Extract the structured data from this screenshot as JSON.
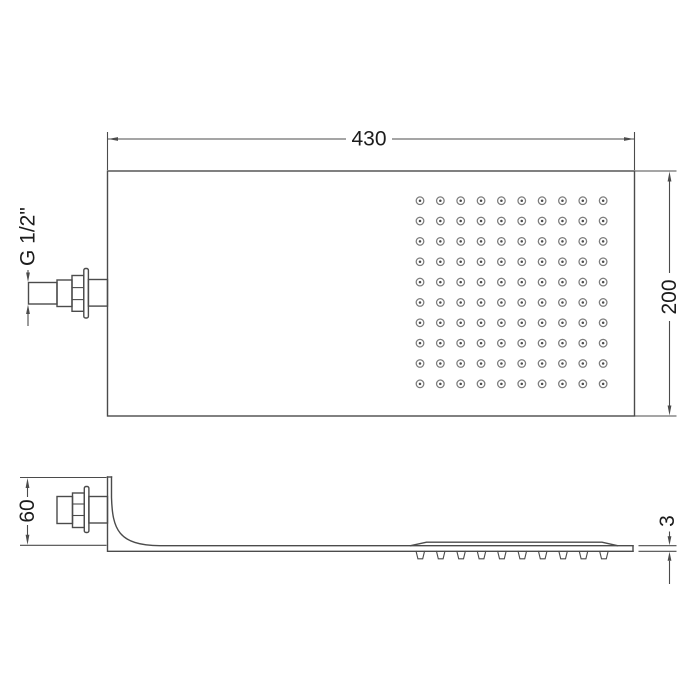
{
  "colors": {
    "line": "#4b4b4b",
    "ring": "#7c7c7c",
    "text": "#1c1c1c",
    "background": "#ffffff"
  },
  "plan_view": {
    "width_label": "430",
    "height_label": "200",
    "thread_label": "G 1/2\"",
    "nozzle_grid": {
      "rows": 10,
      "cols": 10
    }
  },
  "side_view": {
    "height_label": "60",
    "thickness_label": "3",
    "nozzle_count": 10
  }
}
